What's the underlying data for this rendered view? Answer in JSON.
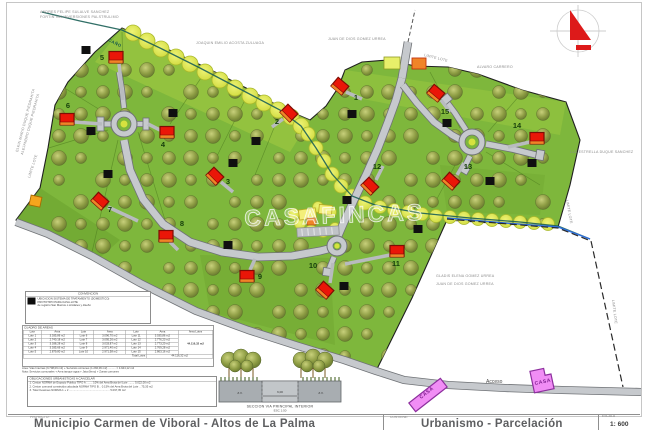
{
  "watermark": "CASAFINCAS",
  "title_block": {
    "project_label": "PROYECTO:",
    "project_title": "Municipio  Carmen de Viboral   -   Altos de La Palma",
    "contains_label": "CONTIENE:",
    "contains_title": "Urbanismo  -  Parcelación",
    "scale_label": "ESCALA",
    "scale_value": "1: 600"
  },
  "map_labels": {
    "owner_top_left_1": "ANDRES FELIPE SULALVE SANCHEZ",
    "owner_top_left_2": "FORTIN 944 INVERSIONES PALSTRULIMO",
    "owner_left_1": "ELKIN MARIO DUQUE PIEDRAHITA",
    "owner_left_2": "ALEJANDRO DUQUE PIEDRAHITA",
    "owner_top_center": "JOAQUIN EMILIO ACOSTA ZULUAGA",
    "owner_top_right": "JUAN DE DIOS GOMEZ URREA",
    "owner_right": "ALVARO CARRERO",
    "owner_far_right": "LUZ ESTRELLA DUQUE SANCHEZ",
    "parcel_owner_1": "GLADIS ELENA GOMEZ URREA",
    "parcel_owner_2": "JUAN DE DIOS GOMEZ URREA",
    "limite_lote": "LIMITE LOTE",
    "creek": "CAÑO",
    "access_road": "Acceso",
    "casa": "CASA"
  },
  "lots": [
    {
      "number": "1"
    },
    {
      "number": "2"
    },
    {
      "number": "3"
    },
    {
      "number": "4"
    },
    {
      "number": "5"
    },
    {
      "number": "6"
    },
    {
      "number": "7"
    },
    {
      "number": "8"
    },
    {
      "number": "9"
    },
    {
      "number": "10"
    },
    {
      "number": "11"
    },
    {
      "number": "12"
    },
    {
      "number": "13"
    },
    {
      "number": "14"
    },
    {
      "number": "15"
    }
  ],
  "convencion": {
    "title": "CONVENCION",
    "line1": "UBICACION SISTEMA DE TRATAMIENTO (DOMESTICO)",
    "line2": "PROTOTIPO PARA CASA-LOTE",
    "line3": "de registro San Marcos o similares y diseño"
  },
  "cuadro_areas": {
    "title": "CUADRO  DE  AREAS",
    "headers": [
      "Lote",
      "Area",
      "Lote",
      "Area",
      "Lote",
      "Area",
      "Area Lotes"
    ],
    "rows": [
      [
        "Lote 1",
        "3.035,86 m2",
        "Lote 6",
        "3.096,70 m2",
        "Lote 11",
        "3.035,86 m2"
      ],
      [
        "Lote 2",
        "2.740,18 m2",
        "Lote 7",
        "3.095,26 m2",
        "Lote 12",
        "2.776,23 m2"
      ],
      [
        "Lote 3",
        "3.038,28 m2",
        "Lote 8",
        "3.033,87 m2",
        "Lote 13",
        "2.773,20 m2"
      ],
      [
        "Lote 4",
        "3.035,66 m2",
        "Lote 9",
        "2.971,40 m2",
        "Lote 14",
        "2.769,28 m2"
      ],
      [
        "Lote 5",
        "2.879,80 m2",
        "Lote 10",
        "2.971,58 m2",
        "Lote 15",
        "2.863,16 m2"
      ]
    ],
    "total_merged": "44.116,32 m2",
    "total_row_label": "Total Lotes",
    "total_row_value": "44.116,32 m2",
    "note1": "Area: Vias Internas (3.708,06 m2) + Servicios comunes (1.236,06 m2) ..........  = 4.944,12 m2",
    "note2": "Nota: Servicios comunales + Area tanque agua + Jata (lleno) + Zonas comunes"
  },
  "obligaciones": {
    "title": "OBLIGACIONES URBANISTICAS A CANCELAR",
    "items": [
      "1. Cesion NORMA de Espacio Publico TIPO A ........ 10% del Area Bruta del Lote ........ 5.022,00 m2",
      "2. Cesion comunal construida calculada NORMA TIPO B .. 0.15% del Area Bruta del Lote .. 75,35 m2",
      "3. Total Cesiones NORMA  1 + 2 ..................................................... 5.097,35 m2"
    ]
  },
  "section": {
    "caption_line1": "SECCION VIA PRINCIPAL INTERIOR",
    "caption_line2": "ESC  1:50",
    "dim_left": "Z.V.",
    "dim_center": "6,00",
    "dim_right": "Z.V."
  }
}
